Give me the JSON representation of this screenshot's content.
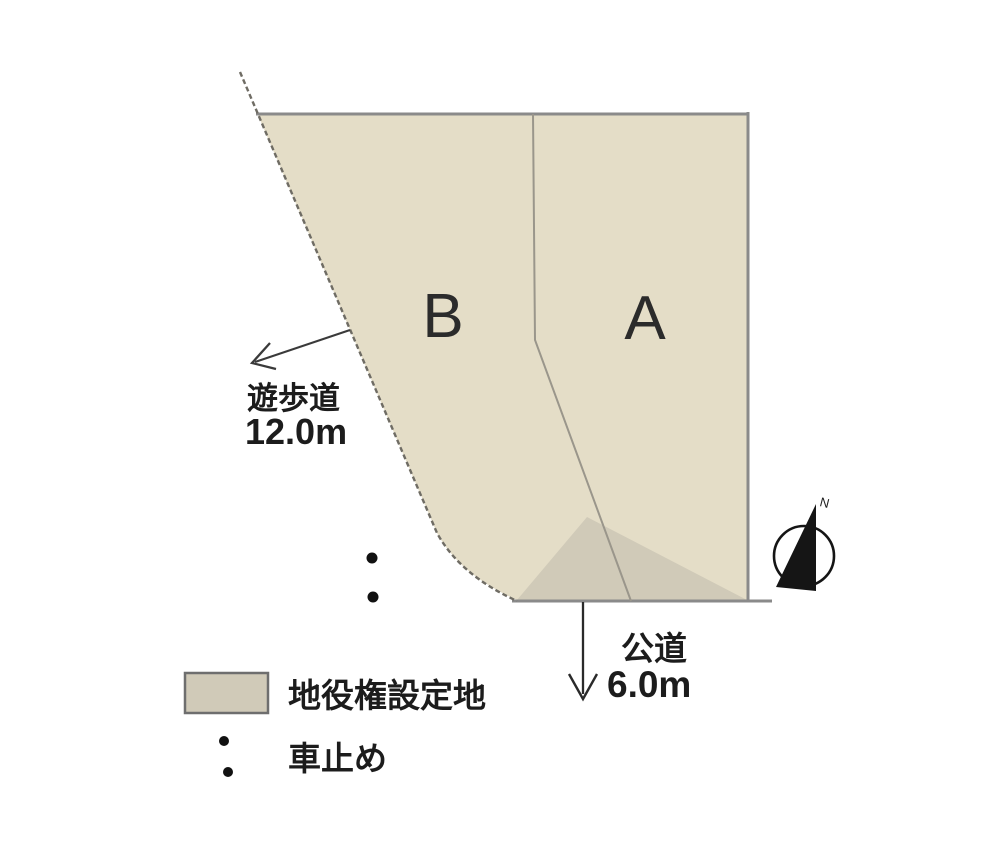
{
  "parcels": {
    "a": "A",
    "b": "B"
  },
  "annotations": {
    "promenade_name": "遊歩道",
    "promenade_width": "12.0m",
    "road_name": "公道",
    "road_width": "6.0m"
  },
  "legend": {
    "easement_label": "地役権設定地",
    "car_stop_label": "車止め"
  },
  "compass": {
    "north_label": "N"
  },
  "colors": {
    "land_fill": "#e4ddc7",
    "easement_fill": "#d0cab8",
    "border_gray": "#8a8a8a",
    "boundary_dark": "#6f6c64",
    "divider_gray": "#9a968b",
    "ink": "#1f1f1f"
  }
}
